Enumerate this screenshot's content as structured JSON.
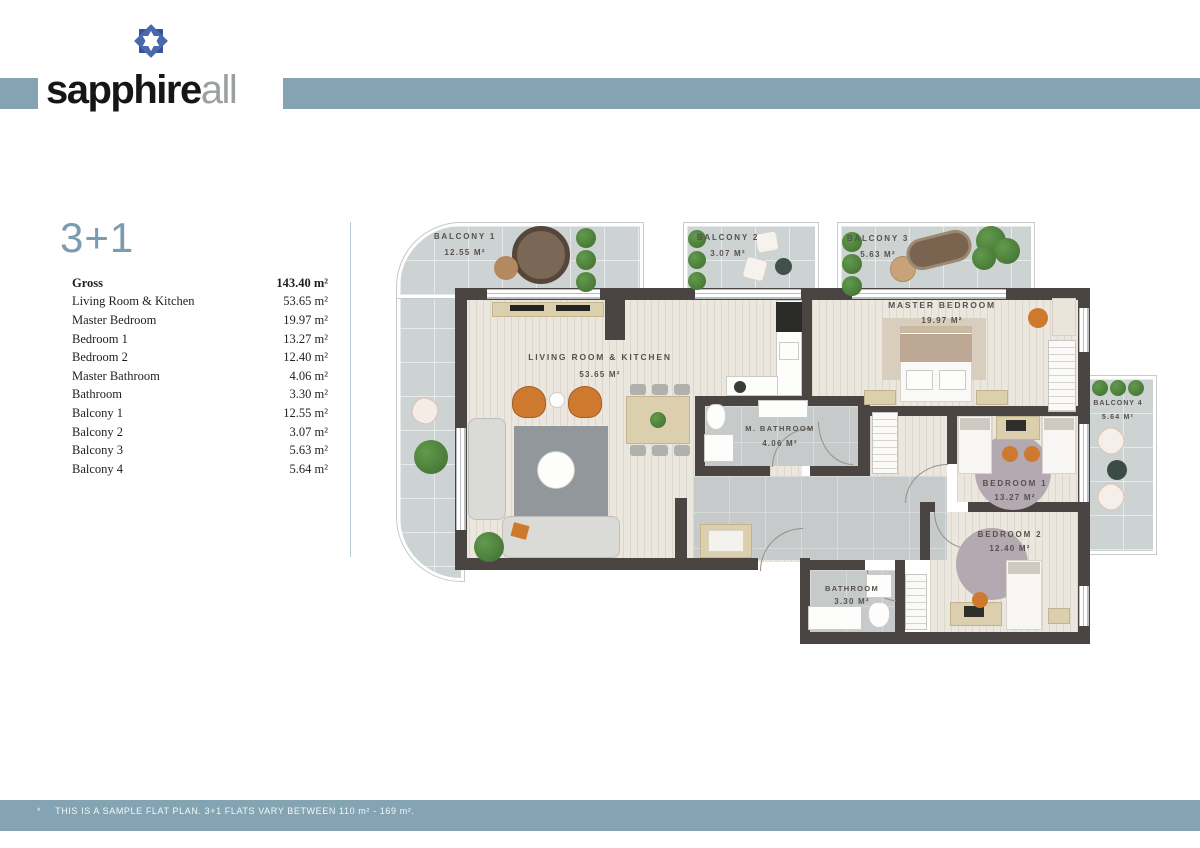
{
  "brand": {
    "word_bold": "sapphire",
    "word_light": "all"
  },
  "unit": {
    "title": "3+1"
  },
  "area_table": {
    "rows": [
      {
        "label": "Gross",
        "value": "143.40 m²"
      },
      {
        "label": "Living Room & Kitchen",
        "value": "53.65 m²"
      },
      {
        "label": "Master Bedroom",
        "value": "19.97 m²"
      },
      {
        "label": "Bedroom 1",
        "value": "13.27 m²"
      },
      {
        "label": "Bedroom 2",
        "value": "12.40 m²"
      },
      {
        "label": "Master Bathroom",
        "value": "4.06 m²"
      },
      {
        "label": "Bathroom",
        "value": "3.30 m²"
      },
      {
        "label": "Balcony 1",
        "value": "12.55 m²"
      },
      {
        "label": "Balcony 2",
        "value": "3.07 m²"
      },
      {
        "label": "Balcony 3",
        "value": "5.63 m²"
      },
      {
        "label": "Balcony 4",
        "value": "5.64 m²"
      }
    ]
  },
  "floor_plan": {
    "rooms": [
      {
        "label": "LIVING ROOM & KITCHEN",
        "area": "53.65 M²"
      },
      {
        "label": "MASTER BEDROOM",
        "area": "19.97 M²"
      },
      {
        "label": "M. BATHROOM",
        "area": "4.06 M²"
      },
      {
        "label": "BEDROOM 1",
        "area": "13.27 M²"
      },
      {
        "label": "BEDROOM 2",
        "area": "12.40 M²"
      },
      {
        "label": "BATHROOM",
        "area": "3.30 M²"
      },
      {
        "label": "BALCONY 1",
        "area": "12.55 M²"
      },
      {
        "label": "BALCONY 2",
        "area": "3.07 M²"
      },
      {
        "label": "BALCONY 3",
        "area": "5.63 M²"
      },
      {
        "label": "BALCONY 4",
        "area": "5.64 M²"
      }
    ]
  },
  "footer": {
    "mark": "*",
    "note": "THIS IS A SAMPLE FLAT PLAN. 3+1 FLATS VARY BETWEEN 110 m² - 169 m²."
  },
  "colors": {
    "band": "#84a3b3",
    "wall": "#4a4543",
    "accent_blue": "#7b9cb0"
  }
}
